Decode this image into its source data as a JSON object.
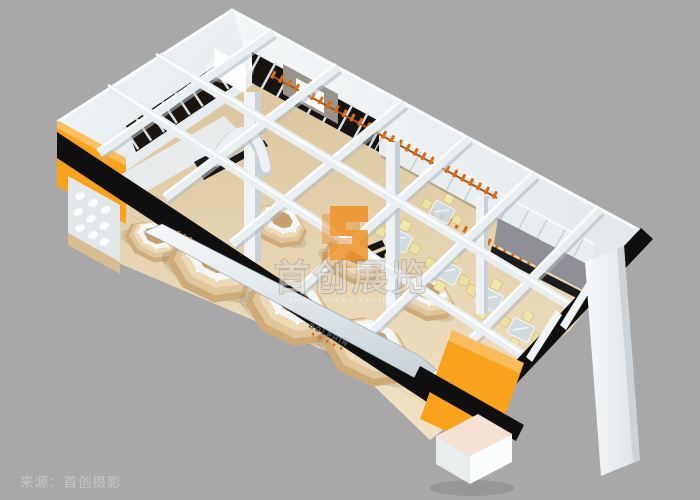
{
  "meta": {
    "background_color": "#a8a8a8",
    "render_type": "3D showroom bird's-eye rendering"
  },
  "watermark": {
    "title": "首创展览",
    "subtitle": "SHOUCHUANG EXHIBITION",
    "logo_color": "#ef8f1f",
    "echo_color": "#e07c12"
  },
  "caption": {
    "text": "来源：首创摄影",
    "color": "#c4c4c4"
  },
  "signage": {
    "blade_text": "DOLPHIN"
  },
  "palette": {
    "accent_orange": "#f9a21c",
    "fascia_black": "#0f0f0f",
    "wall_light": "#eef2f4",
    "floor_wood": "#e6d2ad",
    "counter_wood": "#d2ae7e",
    "chair_cream": "#ebe1a0",
    "slat_orange": "#d96c12",
    "beam_white": "#e9eef1",
    "gray_panel": "#8e9095"
  }
}
